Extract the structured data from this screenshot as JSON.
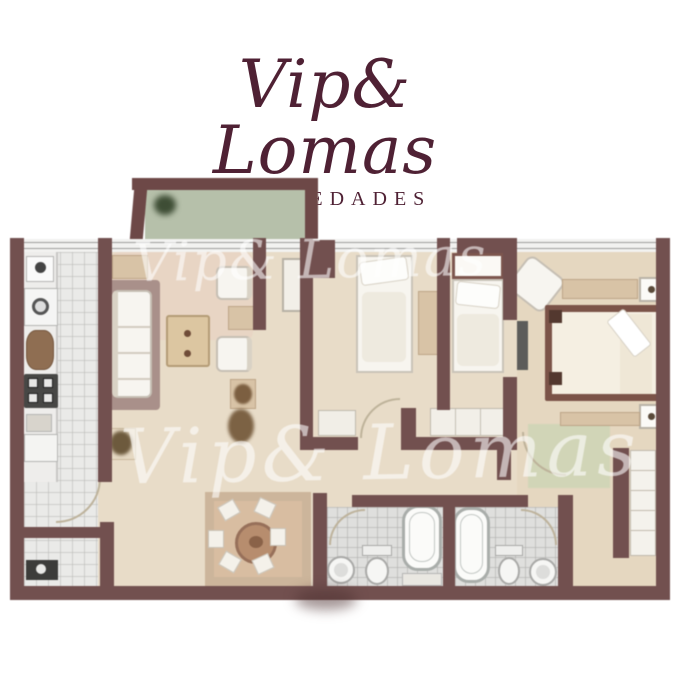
{
  "brand": {
    "name": "Vip& Lomas",
    "subtitle": "PROPIEDADES",
    "color": "#4f2134"
  },
  "watermarks": {
    "top": "Vip& Lomas",
    "middle": "Vip& Lomas",
    "color": "#ffffff"
  },
  "palette": {
    "background": "#ffffff",
    "wall": "#72504f",
    "balcony_wall": "#6d4847",
    "floor": "#e8dcc8",
    "master_floor": "#e5d7c0",
    "kitchen_floor": "#eaeae8",
    "bathroom_floor": "#dfdfdd",
    "balcony_floor": "#b6c0aa",
    "dining_rug": "#d8bda1",
    "sofa_rug": "#a9908a",
    "master_rug": "#d1d5b7",
    "window": "#f2f2f0"
  }
}
